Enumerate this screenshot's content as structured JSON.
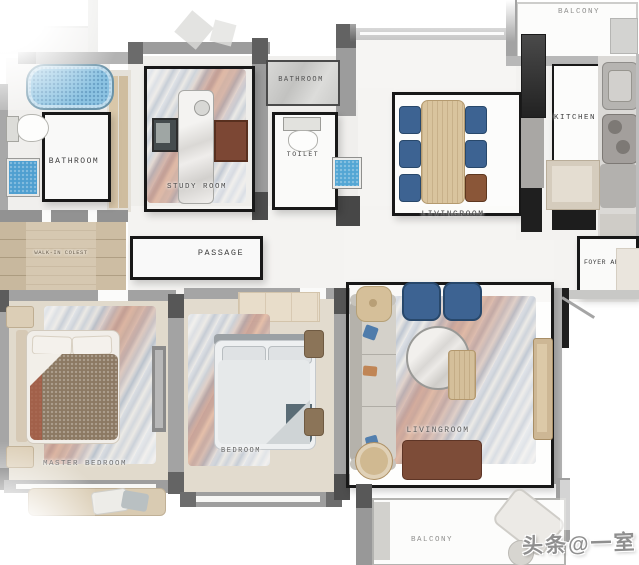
{
  "watermark": "头条@一室",
  "rooms": [
    {
      "id": "balcony-top",
      "label": "BALCONY"
    },
    {
      "id": "bathroom-left",
      "label": "BATHROOM"
    },
    {
      "id": "study-room",
      "label": "STUDY ROOM"
    },
    {
      "id": "bathroom-top",
      "label": "BATHROOM"
    },
    {
      "id": "toilet",
      "label": "TOILET"
    },
    {
      "id": "kitchen",
      "label": "KITCHEN"
    },
    {
      "id": "dining-area",
      "label": "LIVINGROOM"
    },
    {
      "id": "walk-in-closet",
      "label": "WALK-IN COLEST"
    },
    {
      "id": "passage",
      "label": "PASSAGE"
    },
    {
      "id": "foyer",
      "label": "FOYER AREA"
    },
    {
      "id": "master-bedroom",
      "label": "MASTER BEDROOM"
    },
    {
      "id": "bedroom",
      "label": "BEDROOM"
    },
    {
      "id": "living-room",
      "label": "LIVINGROOM"
    },
    {
      "id": "balcony-bottom",
      "label": "BALCONY"
    }
  ],
  "colors": {
    "tub_blue": "#8cc3e2",
    "shower_blue": "#4f9fd0",
    "chair_blue": "#3d6392",
    "table_wood": "#d9c49e",
    "bench_brown": "#7d4c38",
    "wall_gray": "#9a9a9a",
    "rug_accent_red": "#c26a4f"
  }
}
